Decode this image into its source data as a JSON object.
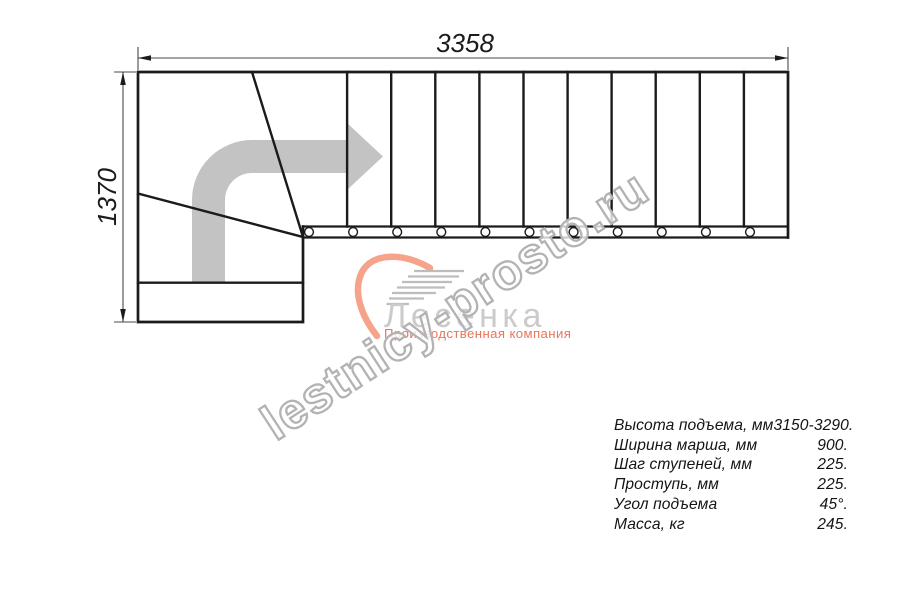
{
  "drawing": {
    "type": "staircase-top-view-plan",
    "top_dimension": "3358",
    "left_dimension": "1370",
    "tread_count_straight": 11,
    "direction_arrow": "up-then-right"
  },
  "logo": {
    "name": "Лесенка",
    "tagline": "Производственная компания"
  },
  "watermark": {
    "text": "lestnicy-prosto.ru"
  },
  "spec_table": {
    "rows": [
      {
        "label": "Высота подъема, мм",
        "value": "3150-3290."
      },
      {
        "label": "Ширина марша, мм",
        "value": "900."
      },
      {
        "label": "Шаг ступеней, мм",
        "value": "225."
      },
      {
        "label": "Проступь, мм",
        "value": "225."
      },
      {
        "label": "Угол подъема",
        "value": "45°."
      },
      {
        "label": "Масса, кг",
        "value": "245."
      }
    ]
  },
  "colors": {
    "line_black": "#1b1b1b",
    "dim_line": "#4a4a4a",
    "arrow_gray": "#c3c3c3",
    "brand": "#f6a38c",
    "tagline_coral": "#e9755c",
    "logo_text_gray": "#cbcbcb",
    "steps_gray": "#bdbdbd",
    "watermark_gray": "#b3b3b3"
  }
}
